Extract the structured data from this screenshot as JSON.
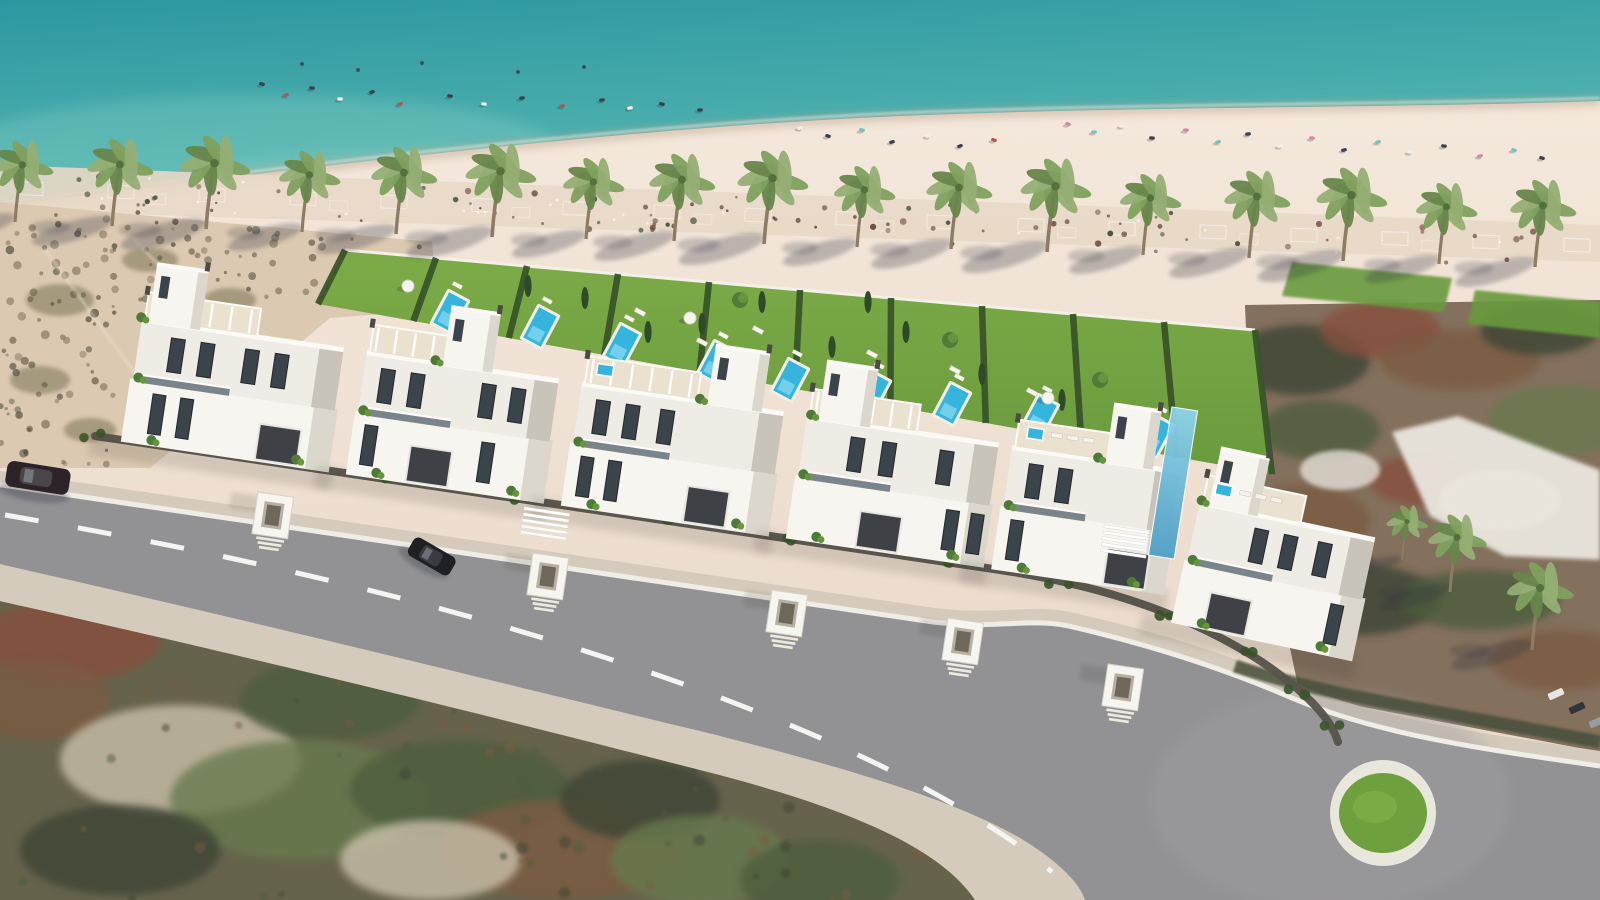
{
  "image": {
    "kind": "aerial-architectural-render",
    "description": "Aerial 3D render of a beachfront row of white modern villas with private garden pools, palm-lined beach, turquoise sea, access road with roundabout, surrounding satellite terrain",
    "width": 1600,
    "height": 900
  },
  "palette": {
    "sea_deep": "#2d96a0",
    "sea_mid": "#4fb2af",
    "sea_shallow": "#7cc9bd",
    "sea_streak": "#8fd4c6",
    "wet_sand": "#bfa58f",
    "foam": "#ffffff",
    "sand_hi": "#f4e8dc",
    "sand_lo": "#e7d6c5",
    "promenade": "#e8d8c7",
    "prom_speck": "#5d4038",
    "prom_speck2": "#744f44",
    "dune": "#dcc9b1",
    "dune_speck": "#6b5f49",
    "dune_speck2": "#49483a",
    "dune_blob": "#6f6a4e",
    "track": "#f0e6d6",
    "lawn_hi": "#7dab48",
    "lawn_lo": "#699a3c",
    "hedge": "#3a5529",
    "cypress": "#2e4a28",
    "tree": "#4e7a37",
    "tree_hi": "#67953f",
    "pool_rim": "#f1eee6",
    "pool_water": "#35b5de",
    "pool_light": "#8fdcf2",
    "palm_frond": "#7fa05e",
    "palm_frond_hi": "#95ae74",
    "palm_frond_lo": "#67864b",
    "palm_trunk": "#8d7b64",
    "shadow": "#2e3240",
    "villa_white": "#f7f5f0",
    "villa_face": "#efece5",
    "villa_shade": "#dcd7cd",
    "villa_dark": "#c9c4b9",
    "roof_deck": "#eae1cf",
    "parapet": "#fbfaf6",
    "glass": "#3b434b",
    "glass_frame": "#22272c",
    "balcony_glass": "#5d6b74",
    "fence": "#56534b",
    "garage": "#3e4145",
    "vent": "#4b4a44",
    "sidewalk": "#d5cbbc",
    "asphalt": "#929194",
    "asphalt_hi": "#a09fa1",
    "curb": "#f0ede6",
    "dash": "#f4f4f2",
    "rb_ring": "#e9e6db",
    "rb_grass": "#6fa03e",
    "terr_green": "#4e5d3e",
    "terr_green2": "#687a4e",
    "terr_brown": "#7b5b43",
    "terr_rust": "#87503c",
    "terr_dark": "#3c4434",
    "terr_pale": "#c9bfa9",
    "club_base": "#83705d",
    "club_roof": "#ebe7df",
    "blue_glass": "#4f9fc6",
    "blue_glass_hi": "#8fd4ea",
    "car_dark": "#2c2328",
    "car_black": "#1e2023",
    "car_glass": "#7d838c",
    "item_colors": [
      "#3c3f4a",
      "#b05555",
      "#f2efe8",
      "#d884a6",
      "#74c3c0",
      "#6a8cc0"
    ]
  },
  "scene": {
    "sea": {
      "rect": [
        0,
        0,
        1600,
        320
      ],
      "streaks": [
        [
          260,
          150,
          300,
          55,
          0.3
        ],
        [
          900,
          200,
          260,
          40,
          0.22
        ],
        [
          1430,
          170,
          220,
          45,
          0.28
        ],
        [
          430,
          180,
          240,
          30,
          0.3
        ]
      ]
    },
    "shoreline": "M0,206 C300,168 620,128 900,116 C1150,106 1400,108 1600,101",
    "sand_path": "M0,206 C300,168 620,128 900,116 C1150,106 1400,108 1600,101 L1600,900 L0,900 Z",
    "promenade": {
      "path": "M0,165 L1600,225 L1600,262 L0,210 Z",
      "grid_count": 18,
      "speck_count": 95,
      "white_speck_count": 25,
      "seed": 11
    },
    "dune": {
      "path": "M0,202 L432,242 L438,310 L330,318 L150,468 L0,468 Z",
      "speck_count": 150,
      "seed": 5,
      "blobs": [
        [
          60,
          300,
          34,
          16
        ],
        [
          150,
          260,
          28,
          12
        ],
        [
          40,
          380,
          30,
          14
        ],
        [
          230,
          300,
          26,
          12
        ],
        [
          90,
          430,
          26,
          12
        ]
      ],
      "tracks": [
        [
          44,
          248,
          196,
          458
        ],
        [
          132,
          236,
          306,
          430
        ]
      ]
    },
    "beach_items": {
      "in_water": [
        [
          302,
          64
        ],
        [
          358,
          70
        ],
        [
          422,
          63
        ],
        [
          518,
          72
        ],
        [
          584,
          67
        ]
      ],
      "left": [
        [
          262,
          84,
          0
        ],
        [
          286,
          95,
          1
        ],
        [
          312,
          88,
          0
        ],
        [
          340,
          99,
          2
        ],
        [
          372,
          92,
          0
        ],
        [
          400,
          104,
          1
        ],
        [
          450,
          96,
          0
        ],
        [
          484,
          104,
          2
        ],
        [
          522,
          98,
          0
        ],
        [
          562,
          106,
          1
        ],
        [
          602,
          100,
          0
        ],
        [
          630,
          108,
          2
        ],
        [
          662,
          104,
          0
        ],
        [
          700,
          110,
          0
        ]
      ],
      "mid": [
        [
          800,
          128,
          2
        ],
        [
          828,
          136,
          0
        ],
        [
          862,
          130,
          4
        ],
        [
          892,
          142,
          0
        ],
        [
          928,
          136,
          2
        ],
        [
          960,
          146,
          0
        ],
        [
          994,
          140,
          1
        ]
      ],
      "right": [
        [
          1068,
          124,
          3
        ],
        [
          1094,
          132,
          4
        ],
        [
          1122,
          126,
          2
        ],
        [
          1152,
          138,
          0
        ],
        [
          1186,
          130,
          3
        ],
        [
          1218,
          142,
          4
        ],
        [
          1248,
          134,
          0
        ],
        [
          1280,
          146,
          2
        ],
        [
          1312,
          138,
          3
        ],
        [
          1344,
          150,
          0
        ],
        [
          1378,
          142,
          4
        ],
        [
          1410,
          152,
          2
        ],
        [
          1444,
          146,
          0
        ],
        [
          1480,
          156,
          3
        ],
        [
          1514,
          150,
          4
        ],
        [
          1542,
          158,
          0
        ]
      ]
    },
    "palms": [
      [
        15,
        222
      ],
      [
        112,
        226
      ],
      [
        206,
        229
      ],
      [
        302,
        232
      ],
      [
        396,
        234
      ],
      [
        492,
        237
      ],
      [
        586,
        239
      ],
      [
        674,
        241
      ],
      [
        764,
        244
      ],
      [
        857,
        247
      ],
      [
        951,
        249
      ],
      [
        1047,
        252
      ],
      [
        1143,
        255
      ],
      [
        1249,
        258
      ],
      [
        1343,
        261
      ],
      [
        1439,
        264
      ],
      [
        1535,
        267
      ]
    ],
    "right_palms": [
      [
        1402,
        560,
        0.62
      ],
      [
        1450,
        592,
        0.88
      ],
      [
        1532,
        650,
        1.0
      ]
    ],
    "club": {
      "path": "M1245,305 L1600,300 L1600,752 L1300,695 L1252,470 Z",
      "roof": "M1392,432 L1458,416 L1526,442 L1600,470 L1600,560 L1505,556 L1430,516 Z",
      "blobs": [
        [
          1300,
          360,
          70,
          35,
          "terr_dark"
        ],
        [
          1380,
          330,
          60,
          28,
          "terr_rust"
        ],
        [
          1460,
          360,
          80,
          30,
          "terr_brown"
        ],
        [
          1540,
          330,
          60,
          25,
          "terr_dark"
        ],
        [
          1320,
          430,
          60,
          30,
          "terr_green"
        ],
        [
          1560,
          420,
          70,
          35,
          "terr_green2"
        ],
        [
          1300,
          520,
          70,
          35,
          "terr_brown"
        ],
        [
          1360,
          600,
          80,
          35,
          "terr_dark"
        ],
        [
          1480,
          600,
          80,
          30,
          "terr_green"
        ],
        [
          1560,
          660,
          70,
          30,
          "terr_brown"
        ],
        [
          1420,
          480,
          50,
          25,
          "terr_rust"
        ]
      ],
      "pale_patches": [
        [
          1500,
          500,
          60,
          30
        ],
        [
          1340,
          470,
          40,
          20
        ]
      ],
      "lawns": [
        "M1292,262 L1452,278 L1444,312 L1282,296 Z",
        "M1475,290 L1600,302 L1600,338 L1468,324 Z"
      ],
      "parking_row": {
        "x": 1108,
        "y": 338,
        "dx": 17,
        "dy": 9,
        "count": 7,
        "angle": 56
      },
      "edge_cars": [
        [
          1556,
          694,
          -24,
          "#e8e6e1"
        ],
        [
          1577,
          708,
          -24,
          "#33343a"
        ],
        [
          1597,
          722,
          -24,
          "#9a9da0"
        ]
      ]
    },
    "gardens": {
      "poly": "M345,250 L1255,330 L1272,474 L318,304 Z",
      "wall": [
        [
          345,
          250
        ],
        [
          1255,
          330
        ]
      ],
      "hedge_count": 11,
      "top_edge": [
        [
          345,
          250
        ],
        [
          1255,
          330
        ]
      ],
      "bottom_edge": [
        [
          318,
          304
        ],
        [
          1272,
          474
        ]
      ],
      "pools": [
        [
          450,
          312
        ],
        [
          540,
          327
        ],
        [
          622,
          345
        ],
        [
          716,
          362
        ],
        [
          790,
          380
        ],
        [
          872,
          392
        ],
        [
          952,
          404
        ],
        [
          1040,
          416
        ],
        [
          1155,
          436
        ]
      ],
      "pool_angle": -62,
      "loungers": [
        [
          640,
          312
        ],
        [
          702,
          342
        ],
        [
          955,
          370
        ],
        [
          1032,
          392
        ],
        [
          872,
          354
        ],
        [
          758,
          330
        ]
      ],
      "parasols": [
        [
          408,
          286
        ],
        [
          690,
          318
        ],
        [
          1048,
          398
        ]
      ],
      "cypresses": [
        [
          585,
          298
        ],
        [
          702,
          324
        ],
        [
          762,
          302
        ],
        [
          832,
          347
        ],
        [
          906,
          332
        ],
        [
          982,
          374
        ],
        [
          868,
          302
        ],
        [
          1062,
          400
        ],
        [
          528,
          286
        ],
        [
          648,
          332
        ]
      ],
      "trees": [
        [
          740,
          300
        ],
        [
          950,
          340
        ],
        [
          1100,
          380
        ]
      ]
    },
    "terrain_bl": {
      "path": "M0,568 L300,632 L700,731 C840,766 950,798 1020,838 C1060,862 1080,884 1085,900 L0,900 Z",
      "blobs": [
        [
          70,
          640,
          90,
          40,
          "terr_rust"
        ],
        [
          40,
          700,
          70,
          40,
          "terr_brown"
        ],
        [
          180,
          760,
          120,
          55,
          "terr_pale"
        ],
        [
          330,
          700,
          90,
          40,
          "terr_green"
        ],
        [
          300,
          800,
          130,
          60,
          "terr_green2"
        ],
        [
          120,
          850,
          100,
          45,
          "terr_dark"
        ],
        [
          460,
          790,
          110,
          50,
          "terr_green"
        ],
        [
          560,
          850,
          120,
          50,
          "terr_brown"
        ],
        [
          640,
          800,
          80,
          40,
          "terr_dark"
        ],
        [
          430,
          860,
          90,
          40,
          "terr_pale"
        ],
        [
          700,
          860,
          90,
          45,
          "terr_green2"
        ],
        [
          820,
          880,
          80,
          40,
          "terr_green"
        ]
      ],
      "speck_count": 60,
      "seed": 7
    },
    "road": {
      "pale": "M-5,470 L935,608 C1004,616 1034,602 1079,614 C1167,634 1237,658 1297,684 C1387,722 1494,735 1600,751 L1600,900 L975,900 C940,848 850,808 700,770 C520,724 300,668 -5,600 Z",
      "asphalt": "M-5,484 L933,622 C1002,630 1032,616 1077,628 C1162,648 1232,672 1292,698 C1382,736 1490,750 1600,766 L1600,900 L1085,900 C1080,884 1060,862 1020,838 C950,798 840,766 700,731 C520,688 300,632 -5,563 Z",
      "curb": "M-5,484 L933,622 C1002,630 1032,616 1077,628 C1162,648 1232,672 1292,698 C1382,736 1490,750 1600,766",
      "dash": "M5,515 C300,565 520,625 700,690 C800,727 880,762 955,805 C1000,832 1030,852 1052,872",
      "roundabout": {
        "cx": 1383,
        "cy": 813,
        "r_ring": 53,
        "r_grass": 44
      },
      "hedge_band": "M1235,666 C1320,694 1420,708 1600,742"
    },
    "fence": {
      "path": "M95,436 L500,496 L1000,570 C1100,585 1190,615 1262,662 C1300,688 1330,715 1338,742",
      "pts": [
        [
          95,
          436
        ],
        [
          240,
          458
        ],
        [
          380,
          478
        ],
        [
          520,
          499
        ],
        [
          660,
          520
        ],
        [
          800,
          541
        ],
        [
          940,
          562
        ],
        [
          1060,
          585
        ],
        [
          1160,
          615
        ],
        [
          1240,
          650
        ],
        [
          1300,
          692
        ],
        [
          1330,
          726
        ]
      ]
    },
    "villas": [
      {
        "x": 225,
        "y": 455,
        "w": 210,
        "tx": -95,
        "tw": 52,
        "win": [
          -70,
          -40,
          5,
          35
        ],
        "gwin": [
          -80,
          -52
        ],
        "gx": 30,
        "pergola": true
      },
      {
        "x": 445,
        "y": 487,
        "w": 200,
        "tx": -20,
        "tw": 50,
        "win": [
          -80,
          -50,
          22,
          52
        ],
        "gwin": [
          -88,
          30
        ],
        "gx": -40,
        "pergola": true
      },
      {
        "x": 665,
        "y": 519,
        "w": 210,
        "tx": 25,
        "tw": 55,
        "win": [
          -85,
          -55,
          -20
        ],
        "gwin": [
          -92,
          -64
        ],
        "gx": 18,
        "pergola": true,
        "jacuzzi": true
      },
      {
        "x": 885,
        "y": 551,
        "w": 200,
        "tx": -85,
        "tw": 52,
        "win": [
          -50,
          -18,
          40
        ],
        "gwin": [
          55,
          80
        ],
        "gx": -30,
        "pergola": true
      },
      {
        "x": 1078,
        "y": 580,
        "w": 175,
        "tx": 10,
        "tw": 48,
        "win": [
          -65,
          -35
        ],
        "gwin": [
          -75
        ],
        "gx": 25,
        "jacuzzi": true,
        "loungers": true
      },
      {
        "x": 1262,
        "y": 640,
        "w": 185,
        "tx": -80,
        "tw": 50,
        "win": [
          -30,
          0,
          35
        ],
        "gwin": [
          60
        ],
        "gx": -60,
        "jacuzzi": true,
        "loungers": true,
        "a": 12
      }
    ],
    "villa_angle": 8.4,
    "porches": [
      [
        258,
        492
      ],
      [
        533,
        553
      ],
      [
        772,
        590
      ],
      [
        948,
        618
      ],
      [
        1108,
        664
      ]
    ],
    "bridges": [
      [
        545,
        524
      ],
      [
        1125,
        542
      ]
    ],
    "glass_tower": {
      "x": 1160,
      "y": 408,
      "w": 26,
      "h": 150,
      "angle": 9
    },
    "cars": {
      "left_edge": [
        20,
        476,
        9
      ],
      "driveway": [
        432,
        556,
        30
      ]
    }
  }
}
